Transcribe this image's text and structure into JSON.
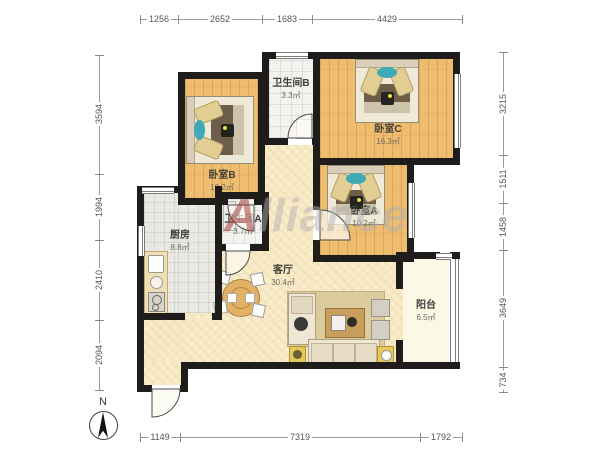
{
  "watermark": {
    "first": "A",
    "rest": "lliance"
  },
  "compass": {
    "label": "N"
  },
  "rooms": {
    "bedroom_b": {
      "name": "卧室B",
      "area": "10.2㎡"
    },
    "bathroom_b": {
      "name": "卫生间B",
      "area": "3.3㎡"
    },
    "bedroom_c": {
      "name": "卧室C",
      "area": "16.3㎡"
    },
    "kitchen": {
      "name": "厨房",
      "area": "8.8㎡"
    },
    "bathroom_a": {
      "name": "卫生间A",
      "area": "3.7㎡"
    },
    "bedroom_a": {
      "name": "卧室A",
      "area": "10.2㎡"
    },
    "living_room": {
      "name": "客厅",
      "area": "30.4㎡"
    },
    "balcony": {
      "name": "阳台",
      "area": "6.5㎡"
    }
  },
  "dimensions": {
    "top": [
      "1256",
      "2652",
      "1683",
      "4429"
    ],
    "bottom": [
      "1149",
      "7319",
      "1792"
    ],
    "left": [
      "3594",
      "1994",
      "2410",
      "2094"
    ],
    "right": [
      "3215",
      "1511",
      "1458",
      "3649",
      "734"
    ]
  },
  "colors": {
    "wall": "#1e1d1b",
    "wood_floor": "#eebd6f",
    "living_floor": "#f7e9c3",
    "balcony_floor": "#fbf8e6",
    "bath_tile": "#f4f3ef",
    "kitchen_tile": "#e9e8e2",
    "accent_teal": "#3fa9b8",
    "duvet_brown": "#6e5d49"
  }
}
